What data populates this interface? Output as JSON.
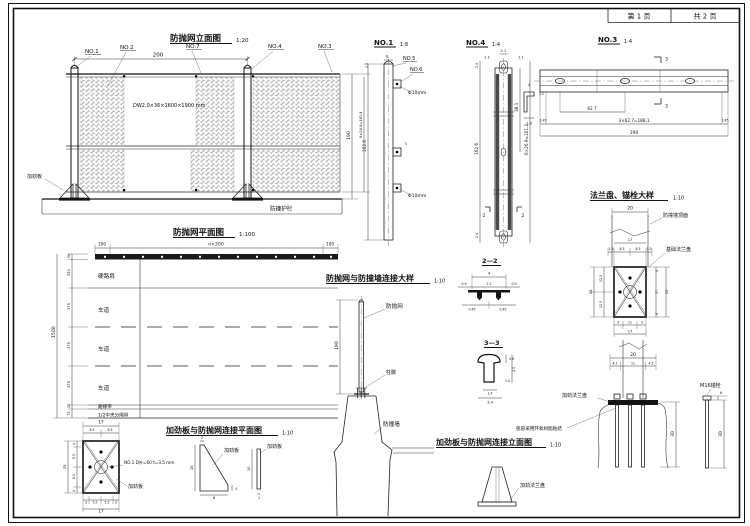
{
  "sheet": {
    "page_label": "第 1 页",
    "total_label": "共 2 页"
  },
  "elev": {
    "title": "防抛网立面图",
    "scale": "1:20",
    "no1": "NO.1",
    "no2": "NO.2",
    "no7": "NO.7",
    "no4": "NO.4",
    "no3": "NO.3",
    "spec": "DW2.0×36×1600×1900 mm",
    "stiffener": "加劲板",
    "guardrail": "防撞护栏",
    "dim_top": "200",
    "dim_h": "190",
    "dim_inner": "6×26.9=161.4",
    "dim_offset": "1.1"
  },
  "plan": {
    "title": "防抛网平面图",
    "scale": "1:100",
    "rows": [
      "硬路肩",
      "车道",
      "车道",
      "车道",
      "路缘带",
      "1/2中央分隔带"
    ],
    "dims_left": [
      "50",
      "250",
      "375",
      "375",
      "375",
      "25",
      "75"
    ],
    "dim_total": "1500",
    "dim_top_left": "100",
    "dim_top_mid": "n×200",
    "dim_top_right": "100"
  },
  "no1": {
    "title": "NO.1",
    "scale": "1:8",
    "no5": "NO.5",
    "no6": "NO.6",
    "hole1": "Φ10mm",
    "hole2": "Φ10mm",
    "dim_w": "8",
    "dim_b": "5",
    "dim_h": "162.6"
  },
  "no4": {
    "title": "NO.4",
    "scale": "1:4",
    "dim_top": "2.2",
    "dim_l": "1.1",
    "dim_r": "1.1",
    "dim_seg": "38.1",
    "dim_total": "6×26.9=161.2",
    "dim_end_t": "2.4",
    "dim_end_b": "2.4",
    "dim_h": "162.6",
    "marker_l": "2",
    "marker_r": "2"
  },
  "cprofile": {
    "dim_t": "4",
    "dim_w": "1.1",
    "dim_h": "1.6"
  },
  "no3": {
    "title": "NO.3",
    "scale": "1:4",
    "dim_seg": "62.7",
    "dim_mid": "3×62.7=188.1",
    "dim_total": "190",
    "dim_end_l": "2.45",
    "dim_end_r": "2.45",
    "marker_t": "3",
    "marker_b": "3"
  },
  "flange": {
    "title": "法兰盘、锚栓大样",
    "scale": "1:10",
    "wall_top_label": "防撞墙顶面",
    "base_plate_label": "基础法兰盘",
    "dim_w": "20",
    "dim_17": "17",
    "dims_top": [
      "1.5",
      "8.5",
      "8.5",
      "1.5"
    ],
    "dims_left": [
      "12.5",
      "12.5"
    ],
    "dim_left_total": "25",
    "dims_right": [
      "4",
      "17",
      "4"
    ],
    "dim_right_total": "25",
    "dims_bottom": [
      "3",
      "11",
      "3"
    ],
    "dim_bottom_total": "17",
    "dim_w2": "20",
    "dims_bottom2": [
      "4.5",
      "11",
      "4.5"
    ]
  },
  "conn": {
    "title": "防抛网与防撞墙连接大样",
    "scale": "1:10",
    "net_label": "防抛网",
    "foot_label": "柱脚",
    "wall_label": "防撞墙",
    "dim_h": "190"
  },
  "sec22": {
    "title": "2—2",
    "dim_top": "4",
    "dim_mid": "2.2",
    "dim_l": "0.9",
    "dim_r": "0.9",
    "dim_bl": "0.45",
    "dim_br": "0.45"
  },
  "sec33": {
    "title": "3—3",
    "dim_a": "0.6",
    "dim_b": "4.5",
    "dim_c": "1.0",
    "dim_d": "1.4",
    "dim_e": "3.4"
  },
  "stiffplan": {
    "title": "加劲板与防抛网连接平面图",
    "scale": "1:10",
    "spec": "NO.1 D外=60 t=3.5 mm",
    "label1": "加劲板",
    "label2": "加劲板",
    "label3": "加劲板",
    "dim_top_total": "17",
    "dims_top": [
      "8.5",
      "8.5"
    ],
    "dims_left": [
      "4",
      "8.5",
      "8.5",
      "4"
    ],
    "dim_left_total": "25",
    "dims_bottom": [
      "3",
      "5.5",
      "5.5",
      "3"
    ],
    "dim_bottom_total": "17",
    "tri": {
      "t": "2",
      "h": "15",
      "w": "8",
      "r": "4"
    },
    "bar": {
      "h": "10",
      "t": "1"
    }
  },
  "stiffelev": {
    "title": "加劲板与防抛网连接立面图",
    "scale": "1:10",
    "flange_label1": "加劲法兰盘",
    "flange_label2": "加劲法兰盘",
    "epoxy_note": "底部采用环氧树脂粘结",
    "bolt_label": "M16锚栓",
    "dim_len1": "30",
    "dim_len2": "30",
    "dim_head": "6"
  }
}
